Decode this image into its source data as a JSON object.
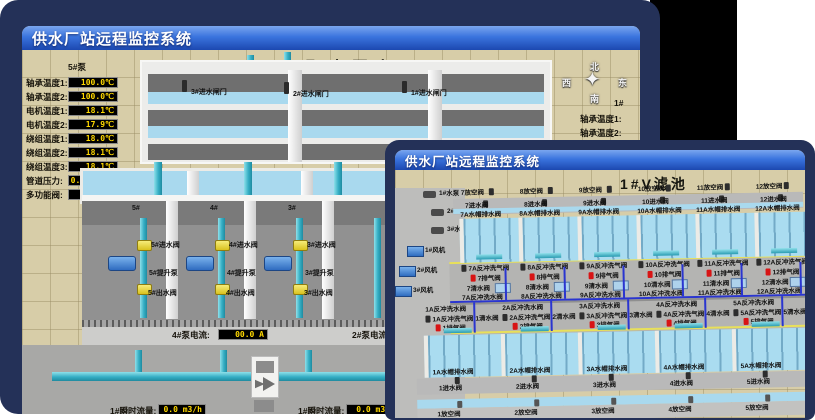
{
  "colors": {
    "frame_navy": "#243158",
    "title_grad_top": "#7aa6ef",
    "title_grad_bottom": "#1c48b0",
    "ground": "#d7cda8",
    "water": "#aadcf0",
    "pipe_cyan": "#35aec4",
    "valve_yellow": "#d9c21e",
    "readout_bg": "#000000",
    "readout_text": "#ffd800",
    "alarm_red": "#d81414",
    "air_pipe_yellow": "#e8e05a",
    "water_pipe_blue": "#2a35d0"
  },
  "back_window": {
    "title_bar": "供水厂站远程监控系统",
    "scene_title": "取水泵房",
    "compass": {
      "n": "北",
      "s": "南",
      "w": "西",
      "e": "东"
    },
    "pump_panel": {
      "header": "5#泵",
      "rows": [
        {
          "label": "轴承温度1:",
          "value": "100.0℃"
        },
        {
          "label": "轴承温度2:",
          "value": "100.0℃"
        },
        {
          "label": "电机温度1:",
          "value": "18.1℃"
        },
        {
          "label": "电机温度2:",
          "value": "17.9℃"
        },
        {
          "label": "绕组温度1:",
          "value": "18.0℃"
        },
        {
          "label": "绕组温度2:",
          "value": "18.1℃"
        },
        {
          "label": "绕组温度3:",
          "value": "18.1℃"
        },
        {
          "label": "管道压力:",
          "value": "0.0007MPa"
        },
        {
          "label": "多功能阀:",
          "value": "0%"
        }
      ]
    },
    "right_panel": {
      "header": "1#",
      "labels": [
        "轴承温度1:",
        "轴承温度2:"
      ]
    },
    "gate_labels": [
      "3#进水闸门",
      "2#进水闸门",
      "1#进水闸门"
    ],
    "bay_headers": [
      "5#",
      "4#",
      "3#"
    ],
    "bays": [
      {
        "inlet": "5#进水阀",
        "pump": "5#提升泵",
        "outlet": "5#出水阀"
      },
      {
        "inlet": "4#进水阀",
        "pump": "4#提升泵",
        "outlet": "4#出水阀"
      },
      {
        "inlet": "3#进水阀",
        "pump": "3#提升泵",
        "outlet": "3#出水阀"
      }
    ],
    "current_meters": [
      {
        "label": "4#泵电流:",
        "value": "00.0 A"
      },
      {
        "label": "2#泵电流:",
        "value": ""
      }
    ],
    "flow_meters": [
      {
        "label": "1#瞬时流量:",
        "value": "0.0 m3/h"
      },
      {
        "label": "1#瞬时流量:",
        "value": "0.0 m3/"
      }
    ]
  },
  "front_window": {
    "title_bar": "供水厂站远程监控系统",
    "scene_title": "1#V滤池",
    "pumps": [
      "1#水泵",
      "2#水泵",
      "3#水泵"
    ],
    "blowers": [
      "1#风机",
      "2#风机",
      "3#风机"
    ],
    "top_cells": [
      {
        "vent": "7放空阀",
        "inlet": "7进水阀",
        "cap_drain": "7A水帽排水阀",
        "bw_air": "7A反冲洗气阀",
        "exhaust": "7排气阀",
        "clean": "7清水阀",
        "bw_water": "7A反冲洗水阀"
      },
      {
        "vent": "8放空阀",
        "inlet": "8进水阀",
        "cap_drain": "8A水帽排水阀",
        "bw_air": "8A反冲洗气阀",
        "exhaust": "8排气阀",
        "clean": "8清水阀",
        "bw_water": "8A反冲洗水阀"
      },
      {
        "vent": "9放空阀",
        "inlet": "9进水阀",
        "cap_drain": "9A水帽排水阀",
        "bw_air": "9A反冲洗气阀",
        "exhaust": "9排气阀",
        "clean": "9清水阀",
        "bw_water": "9A反冲洗水阀"
      },
      {
        "vent": "10放空阀",
        "inlet": "10进水阀",
        "cap_drain": "10A水帽排水阀",
        "bw_air": "10A反冲洗气阀",
        "exhaust": "10排气阀",
        "clean": "10清水阀",
        "bw_water": "10A反冲洗水阀"
      },
      {
        "vent": "11放空阀",
        "inlet": "11进水阀",
        "cap_drain": "11A水帽排水阀",
        "bw_air": "11A反冲洗气阀",
        "exhaust": "11排气阀",
        "clean": "11清水阀",
        "bw_water": "11A反冲洗水阀"
      },
      {
        "vent": "12放空阀",
        "inlet": "12进水阀",
        "cap_drain": "12A水帽排水阀",
        "bw_air": "12A反冲洗气阀",
        "exhaust": "12排气阀",
        "clean": "12清水阀",
        "bw_water": "12A反冲洗水阀"
      }
    ],
    "bottom_cells": [
      {
        "bw_water": "1A反冲洗水阀",
        "bw_air": "1A反冲洗气阀",
        "clean": "1清水阀",
        "exhaust": "1排气阀",
        "cap_drain": "1A水帽排水阀",
        "inlet": "1进水阀",
        "vent": "1放空阀"
      },
      {
        "bw_water": "2A反冲洗水阀",
        "bw_air": "2A反冲洗气阀",
        "clean": "2清水阀",
        "exhaust": "2排气阀",
        "cap_drain": "2A水帽排水阀",
        "inlet": "2进水阀",
        "vent": "2放空阀"
      },
      {
        "bw_water": "3A反冲洗水阀",
        "bw_air": "3A反冲洗气阀",
        "clean": "3清水阀",
        "exhaust": "3排气阀",
        "cap_drain": "3A水帽排水阀",
        "inlet": "3进水阀",
        "vent": "3放空阀"
      },
      {
        "bw_water": "4A反冲洗水阀",
        "bw_air": "4A反冲洗气阀",
        "clean": "4清水阀",
        "exhaust": "4排气阀",
        "cap_drain": "4A水帽排水阀",
        "inlet": "4进水阀",
        "vent": "4放空阀"
      },
      {
        "bw_water": "5A反冲洗水阀",
        "bw_air": "5A反冲洗气阀",
        "clean": "5清水阀",
        "exhaust": "5排气阀",
        "cap_drain": "5A水帽排水阀",
        "inlet": "5进水阀",
        "vent": "5放空阀"
      },
      {
        "bw_water": "6A反冲洗水阀",
        "bw_air": "6A反冲洗气阀",
        "clean": "6清水阀",
        "exhaust": "6排气阀",
        "cap_drain": "6A水帽排水阀",
        "inlet": "6进水阀",
        "vent": "6放空阀"
      }
    ]
  }
}
